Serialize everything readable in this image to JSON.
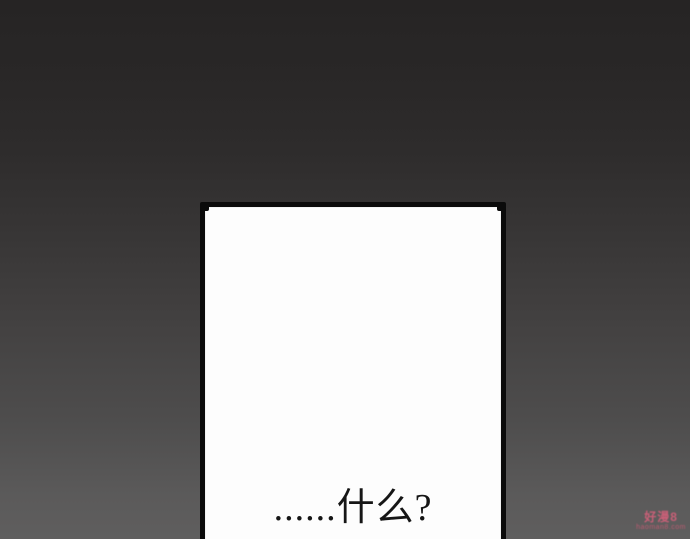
{
  "page": {
    "type": "comic-page",
    "background_top_color": "#262424",
    "background_bottom_color": "#5f5e5e"
  },
  "panel": {
    "border_color": "#0b0b0b",
    "fill_color": "#fdfdfd",
    "dialogue_text": "......什么?",
    "text_color": "#161616"
  },
  "watermark": {
    "title": "好漫8",
    "url": "haoman8.com",
    "color": "#d4607a"
  }
}
